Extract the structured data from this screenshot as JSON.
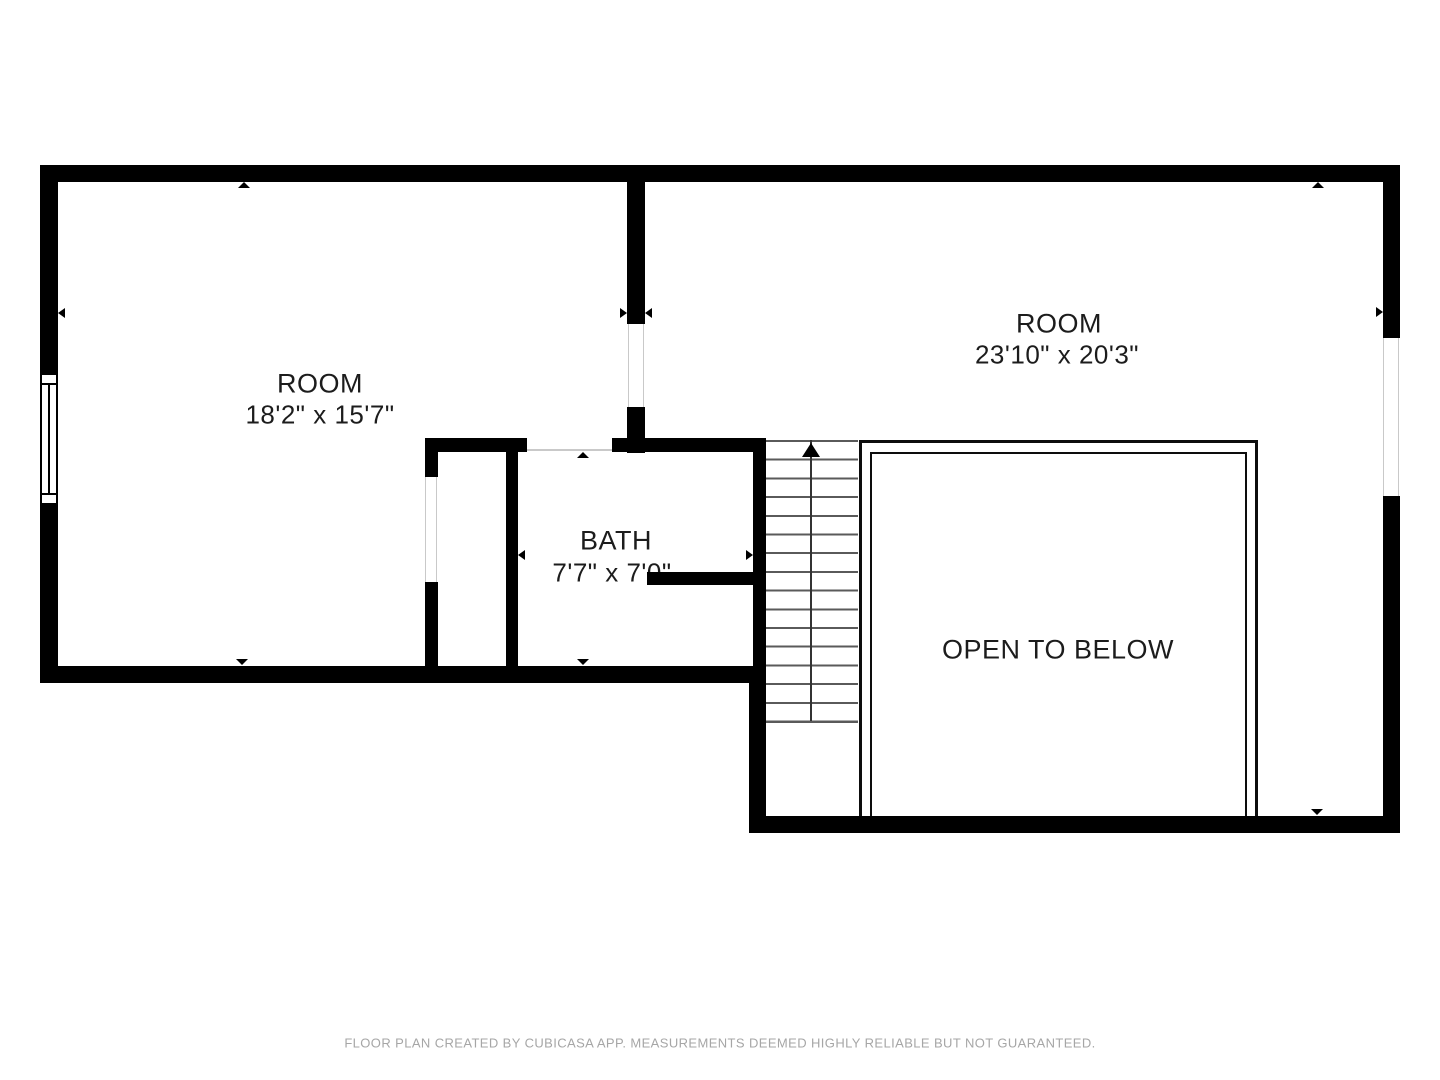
{
  "plan": {
    "rooms": [
      {
        "id": "room-left",
        "name": "ROOM",
        "dims": "18'2\" x 15'7\""
      },
      {
        "id": "room-right",
        "name": "ROOM",
        "dims": "23'10\" x 20'3\""
      },
      {
        "id": "bath",
        "name": "BATH",
        "dims": "7'7\" x 7'0\""
      }
    ],
    "open_to_below_label": "OPEN TO BELOW",
    "footer": "FLOOR PLAN CREATED BY CUBICASA APP. MEASUREMENTS DEEMED HIGHLY RELIABLE BUT NOT GUARANTEED."
  },
  "colors": {
    "wall": "#000000",
    "label": "#1c1c1c",
    "footer": "#a6a6a6",
    "tread": "#5a5a5a",
    "thin": "#c9c9c9"
  }
}
